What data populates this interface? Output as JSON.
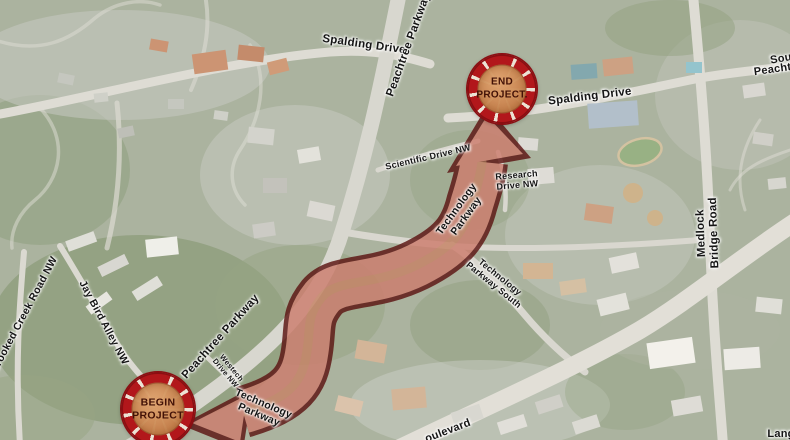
{
  "map": {
    "badges": {
      "begin": {
        "line1": "BEGIN",
        "line2": "PROJECT"
      },
      "end": {
        "line1": "END",
        "line2": "PROJECT."
      }
    },
    "road_labels": [
      {
        "name": "spalding-drive-west",
        "text": "Spalding Drive"
      },
      {
        "name": "peachtree-parkway-north",
        "text": "Peachtree Parkway"
      },
      {
        "name": "spalding-drive-east",
        "text": "Spalding Drive"
      },
      {
        "name": "south-road-fragment",
        "text": "Sou"
      },
      {
        "name": "peachtree-road-fragment",
        "text": "Peachtre"
      },
      {
        "name": "scientific-drive-nw",
        "text": "Scientific Drive NW"
      },
      {
        "name": "research-drive-nw",
        "text": "Research\nDrive NW"
      },
      {
        "name": "technology-parkway-upper",
        "text": "Technology\nParkway"
      },
      {
        "name": "technology-parkway-south",
        "text": "Technology\nParkway South"
      },
      {
        "name": "medlock-bridge-road",
        "text": "Medlock Bridge Road"
      },
      {
        "name": "peachtree-parkway-south",
        "text": "Peachtree Parkway"
      },
      {
        "name": "westech-drive-nw",
        "text": "Westech\nDrive NW"
      },
      {
        "name": "technology-parkway-lower",
        "text": "Technology\nParkway"
      },
      {
        "name": "crooked-creek-road-nw",
        "text": "Crooked Creek Road NW"
      },
      {
        "name": "jay-bird-alley-nw",
        "text": "Jay Bird Alley NW"
      },
      {
        "name": "boulevard-fragment",
        "text": "oulevard"
      },
      {
        "name": "langford-fragment",
        "text": "Lang"
      }
    ]
  },
  "colors": {
    "badge_ring_red": "#b2171b",
    "badge_inner_tan": "#c98a5e",
    "arrow_fill": "#cd7d6e",
    "arrow_outline": "#5c1412"
  }
}
